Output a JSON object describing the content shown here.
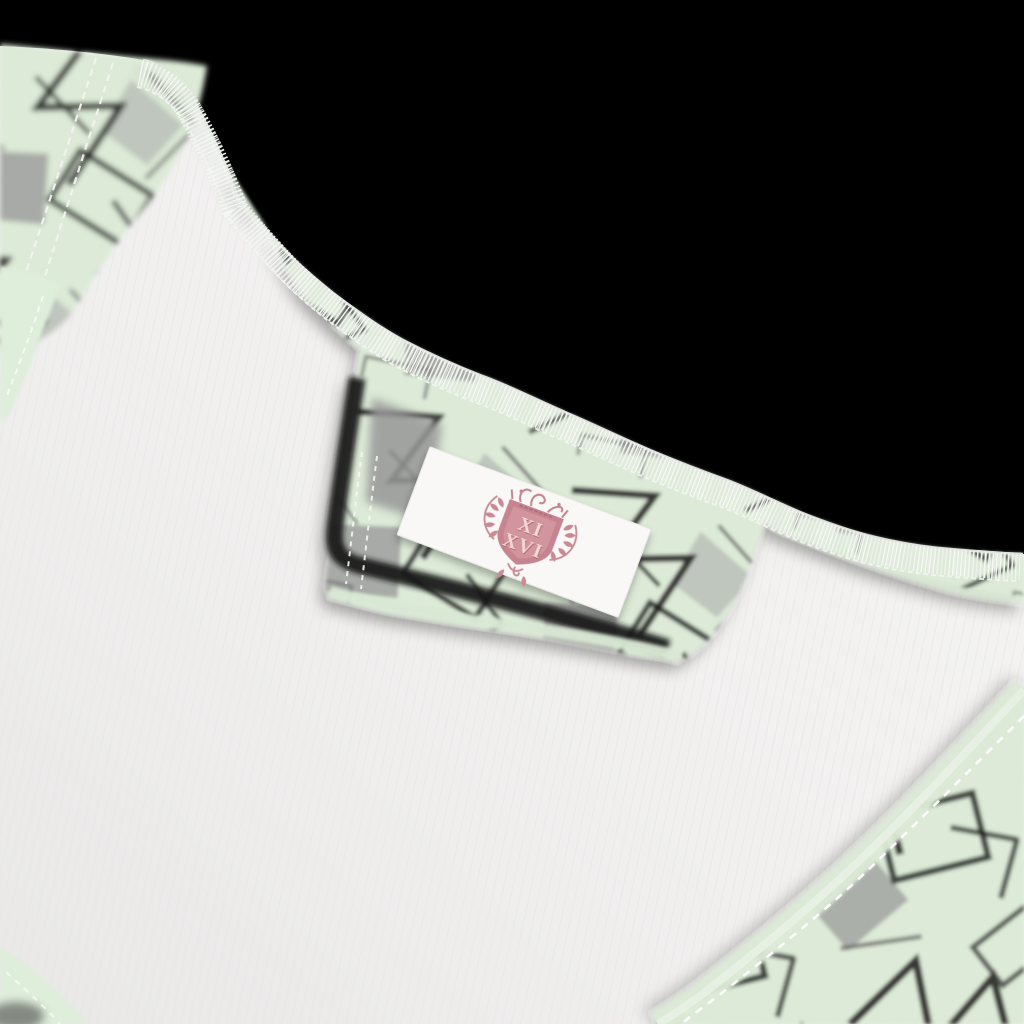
{
  "photo": {
    "subject": "inside-back-neckline-of-garment-with-brand-label",
    "label": {
      "numerals_line1": "XI",
      "numerals_line2": "XVI"
    },
    "colors": {
      "background": "#000000",
      "fabric_mint": "#dcead7",
      "fabric_mint_light": "#e7f1e3",
      "pattern_black": "#161616",
      "pattern_gray": "#9a9a9a",
      "inner_fabric": "#f2f1f0",
      "inner_fabric_shade": "#e8e7e6",
      "label_white": "#f9f8f6",
      "crest_frame_pink": "#c5848f",
      "crest_field_pink": "#d2949e",
      "crest_text_pink": "#f2d8d3",
      "crest_emboss_pink": "#b06e7a",
      "crest_leaf_pink": "#ca8a95",
      "stitch_white": "#f5f7f3"
    }
  }
}
